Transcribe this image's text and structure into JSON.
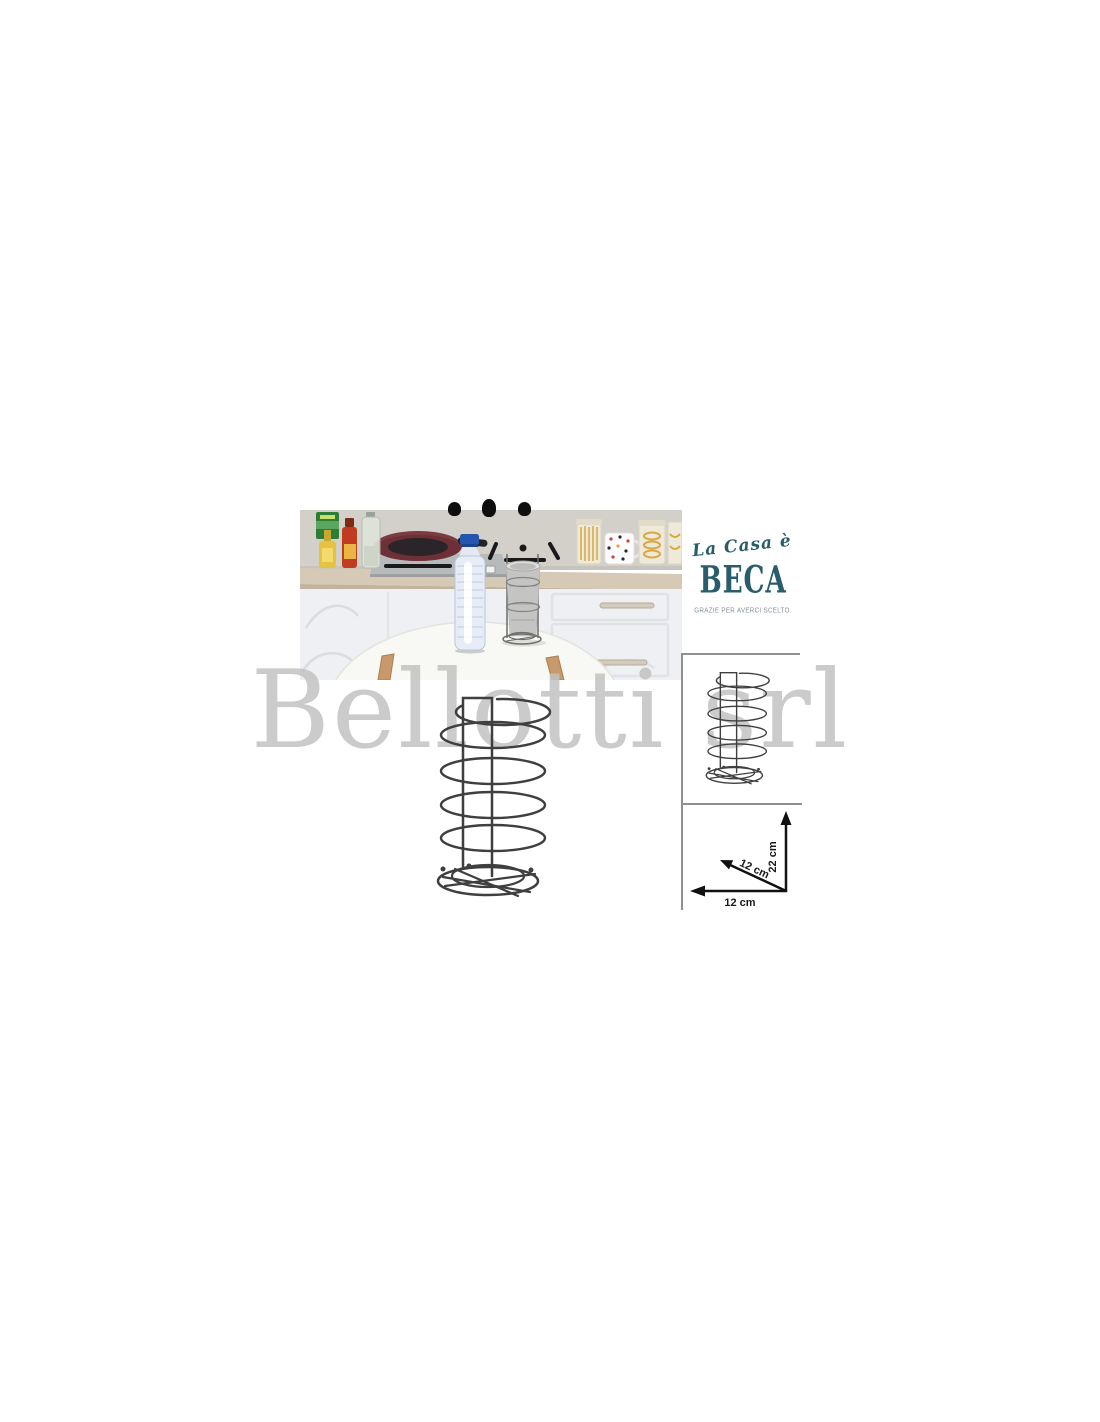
{
  "canvas": {
    "background": "#ffffff"
  },
  "brand": {
    "script_text": "La Casa è",
    "name": "BECA",
    "tagline": "GRAZIE PER AVERCI SCELTO",
    "color": "#2a5d6c",
    "tagline_color": "#84929a"
  },
  "watermark": {
    "text": "Bellotti srl",
    "color": "#c2c2c2"
  },
  "product": {
    "illustration": "spiral-wire-bottle-holder",
    "wire_color": "#3f3f3f"
  },
  "dimensions": {
    "height": "22 cm",
    "depth": "12 cm",
    "width": "12 cm",
    "arrow_color": "#111111"
  }
}
